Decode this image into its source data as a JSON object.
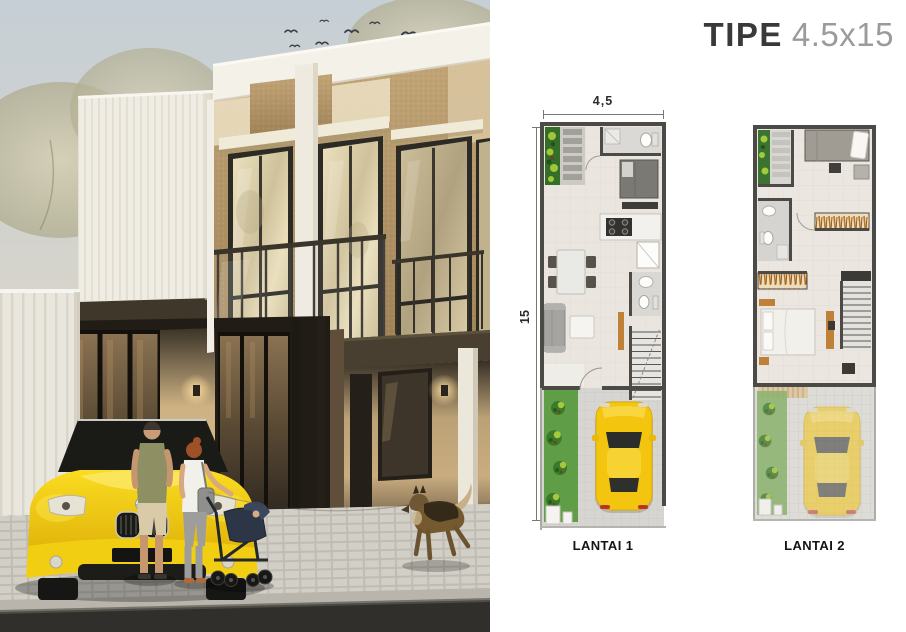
{
  "title": {
    "bold": "TIPE",
    "regular": "4.5x15"
  },
  "plans": {
    "width_dim": "4,5",
    "height_dim": "15",
    "floor1": {
      "label": "LANTAI 1"
    },
    "floor2": {
      "label": "LANTAI 2"
    }
  },
  "palette": {
    "title_dark": "#39393b",
    "title_muted": "#9b9b9d",
    "plan_wall": "#4b4a47",
    "plan_floor": "#eae6df",
    "car_yellow": "#f3c50e",
    "garden_green": "#3c7a2b",
    "wood_accent": "#bf8037"
  },
  "scene": {
    "elements": [
      "two-storey-house-render",
      "yellow-roadster",
      "man-figure",
      "woman-figure",
      "baby-stroller",
      "german-shepherd-dog",
      "bird-flock",
      "white-slat-fence",
      "paved-sidewalk",
      "asphalt-road"
    ]
  }
}
